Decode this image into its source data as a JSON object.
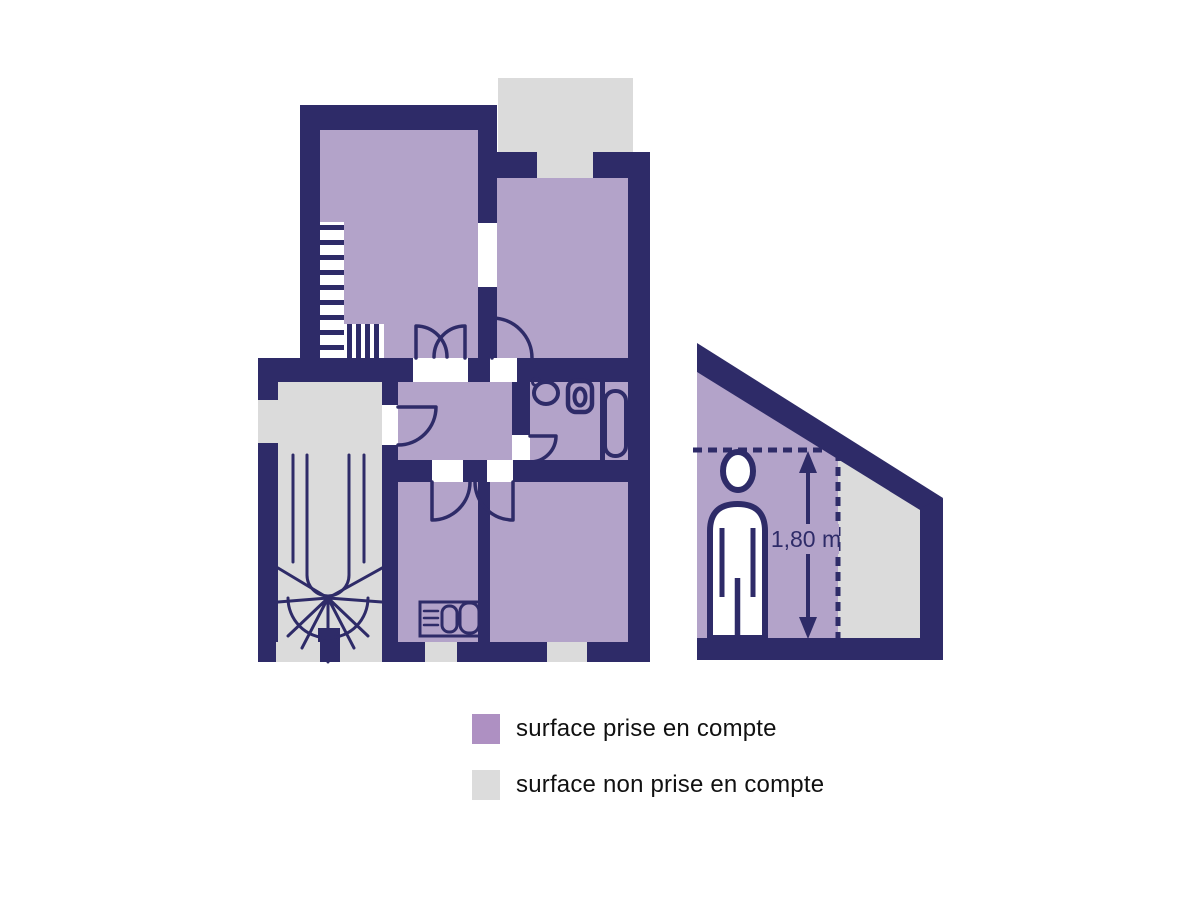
{
  "figure": {
    "type": "floor-plan-surface-diagram",
    "section": {
      "height_label": "1,80 m"
    },
    "legend": {
      "items": [
        {
          "id": "counted",
          "label": "surface prise en compte"
        },
        {
          "id": "not_counted",
          "label": "surface non prise en compte"
        }
      ]
    }
  },
  "colors": {
    "wall": "#2e2b68",
    "surface_counted": "#b3a3c9",
    "surface_not_counted": "#dbdbdb",
    "legend_counted": "#ae90c2",
    "legend_not_counted": "#dcdcdc",
    "opening_white": "#ffffff",
    "text": "#111111",
    "background": "#ffffff"
  }
}
